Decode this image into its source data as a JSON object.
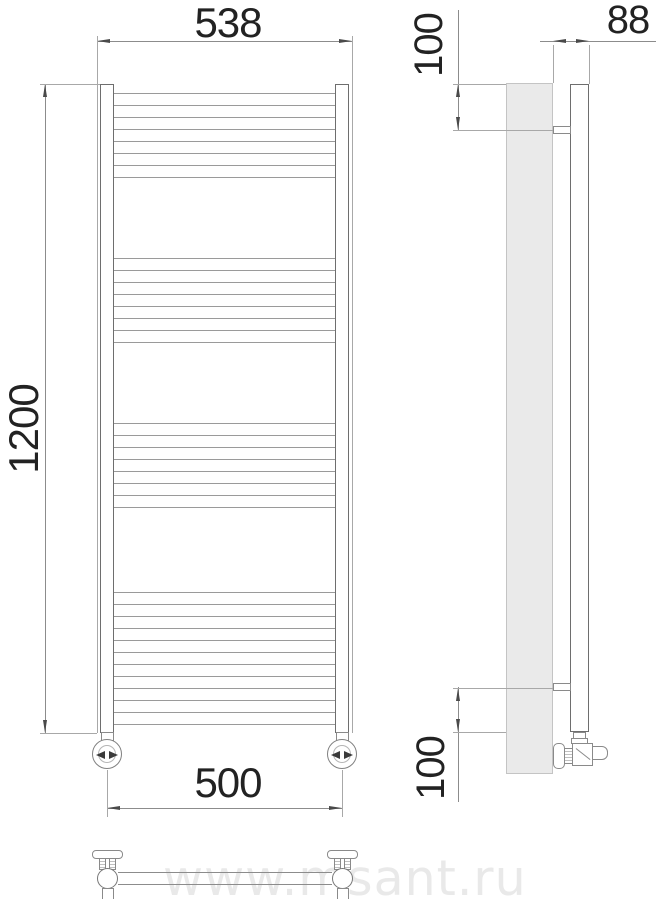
{
  "labels": {
    "front_top_width": "538",
    "front_height": "1200",
    "front_bottom_width": "500",
    "side_top_offset": "100",
    "side_depth": "88",
    "side_bottom_offset": "100"
  },
  "watermark": {
    "text": "www.msant.ru",
    "color": "#e9e9e9"
  },
  "drawing": {
    "type": "towel-radiator-dimension-drawing",
    "line_color": "#8c8c8c",
    "rung_color": "#9a9a9a",
    "wall_fill": "#eaeaea",
    "front_view": {
      "collectors": [
        {
          "x": 100,
          "y": 84,
          "w": 14,
          "h": 649
        },
        {
          "x": 335,
          "y": 84,
          "w": 14,
          "h": 649
        }
      ],
      "rungs": {
        "x": 114,
        "width": 221,
        "groups": [
          {
            "start": 93,
            "count": 8,
            "step": 12
          },
          {
            "start": 258,
            "count": 8,
            "step": 12
          },
          {
            "start": 423,
            "count": 8,
            "step": 12
          },
          {
            "start": 592,
            "count": 12,
            "step": 12
          }
        ]
      }
    }
  }
}
